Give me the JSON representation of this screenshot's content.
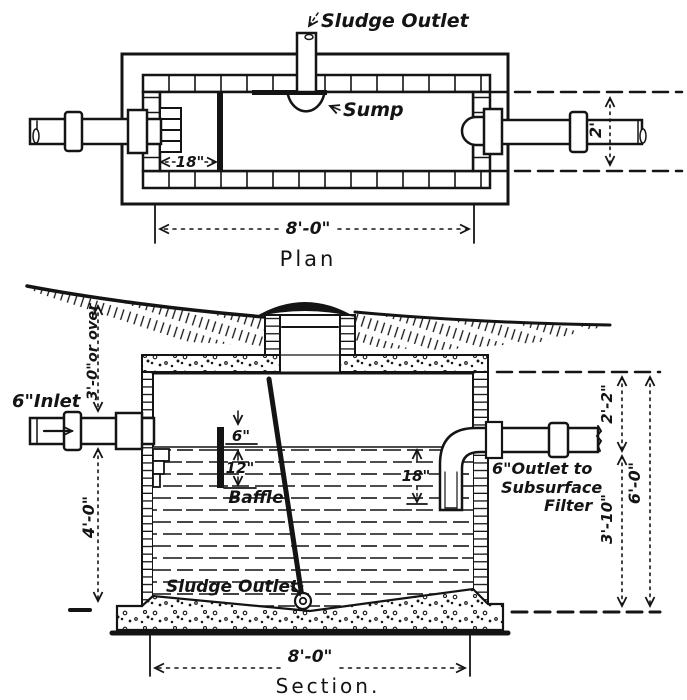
{
  "drawing": {
    "plan": {
      "title": "Plan",
      "sludge_outlet": "Sludge Outlet",
      "sump": "Sump",
      "dim_baffle": "18\"",
      "dim_length": "8'-0\"",
      "dim_width": "2'"
    },
    "section": {
      "title": "Section.",
      "inlet": "6\"Inlet",
      "dim_cover": "3'-0\"or over",
      "dim_inlet_depth": "4'-0\"",
      "dim_baffle_above": "6\"",
      "dim_baffle_below": "12\"",
      "baffle": "Baffle",
      "dim_outlet_submerge": "18\"",
      "outlet_line1": "6\"Outlet to",
      "outlet_line2": "Subsurface",
      "outlet_line3": "Filter",
      "dim_air_space": "2'-2\"",
      "dim_water_depth": "3'-10\"",
      "dim_total_depth": "6'-0\"",
      "sludge_outlet": "Sludge Outlet",
      "dim_length": "8'-0\""
    }
  }
}
